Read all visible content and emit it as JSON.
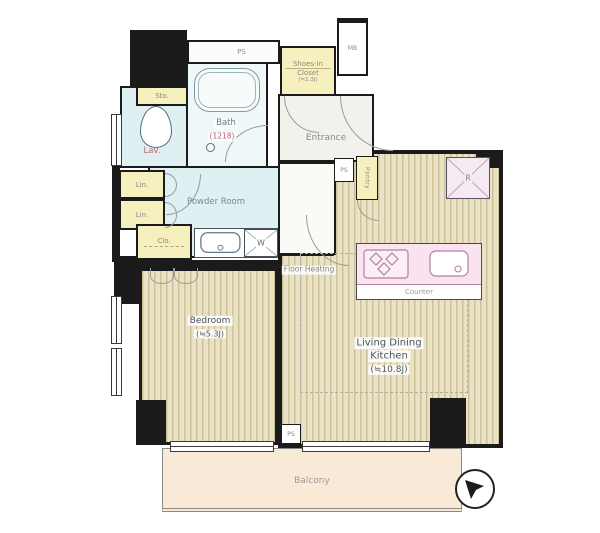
{
  "title": "Apartment floor plan",
  "rooms": {
    "bedroom": {
      "name": "Bedroom",
      "size": "(≒5.3J)"
    },
    "living_dining_kitchen": {
      "name_line1": "Living Dining",
      "name_line2": "Kitchen",
      "size": "(≒10.8J)"
    },
    "bath": {
      "name": "Bath",
      "size": "(1218)"
    },
    "lavatory": {
      "name": "Lav."
    },
    "powder_room": {
      "name": "Powder Room"
    },
    "entrance": {
      "name": "Entrance"
    },
    "balcony": {
      "name": "Balcony"
    },
    "shoes_in_closet": {
      "name_line1": "Shoes-in",
      "name_line2": "Closet",
      "size": "(≒1.3J)"
    }
  },
  "storage": {
    "sto": "Sto.",
    "lin_upper": "Lin.",
    "lin_lower": "Lin.",
    "clo": "Clo.",
    "pantry": "Pantry"
  },
  "utility": {
    "ps_top": "PS",
    "ps_kitchen": "PS",
    "ps_bottom": "PS",
    "mb": "MB",
    "washer": "W",
    "fridge": "R",
    "counter": "Counter",
    "floor_heating": "Floor Heating"
  },
  "colors": {
    "wall": "#1b1b1b",
    "closet_yellow": "#f6efbe",
    "wet_room_blue": "#dff0f2",
    "bath_bg": "#eff8f9",
    "floor_stripe": "#cdc297",
    "floor_base": "#e9e2c7",
    "counter_pink": "#f8e3ef",
    "fridge_pink": "#f5e9f2",
    "balcony_peach": "#f9ead8",
    "label_gray": "#84848a",
    "label_dark": "#46525e",
    "label_red": "#c4606f"
  }
}
